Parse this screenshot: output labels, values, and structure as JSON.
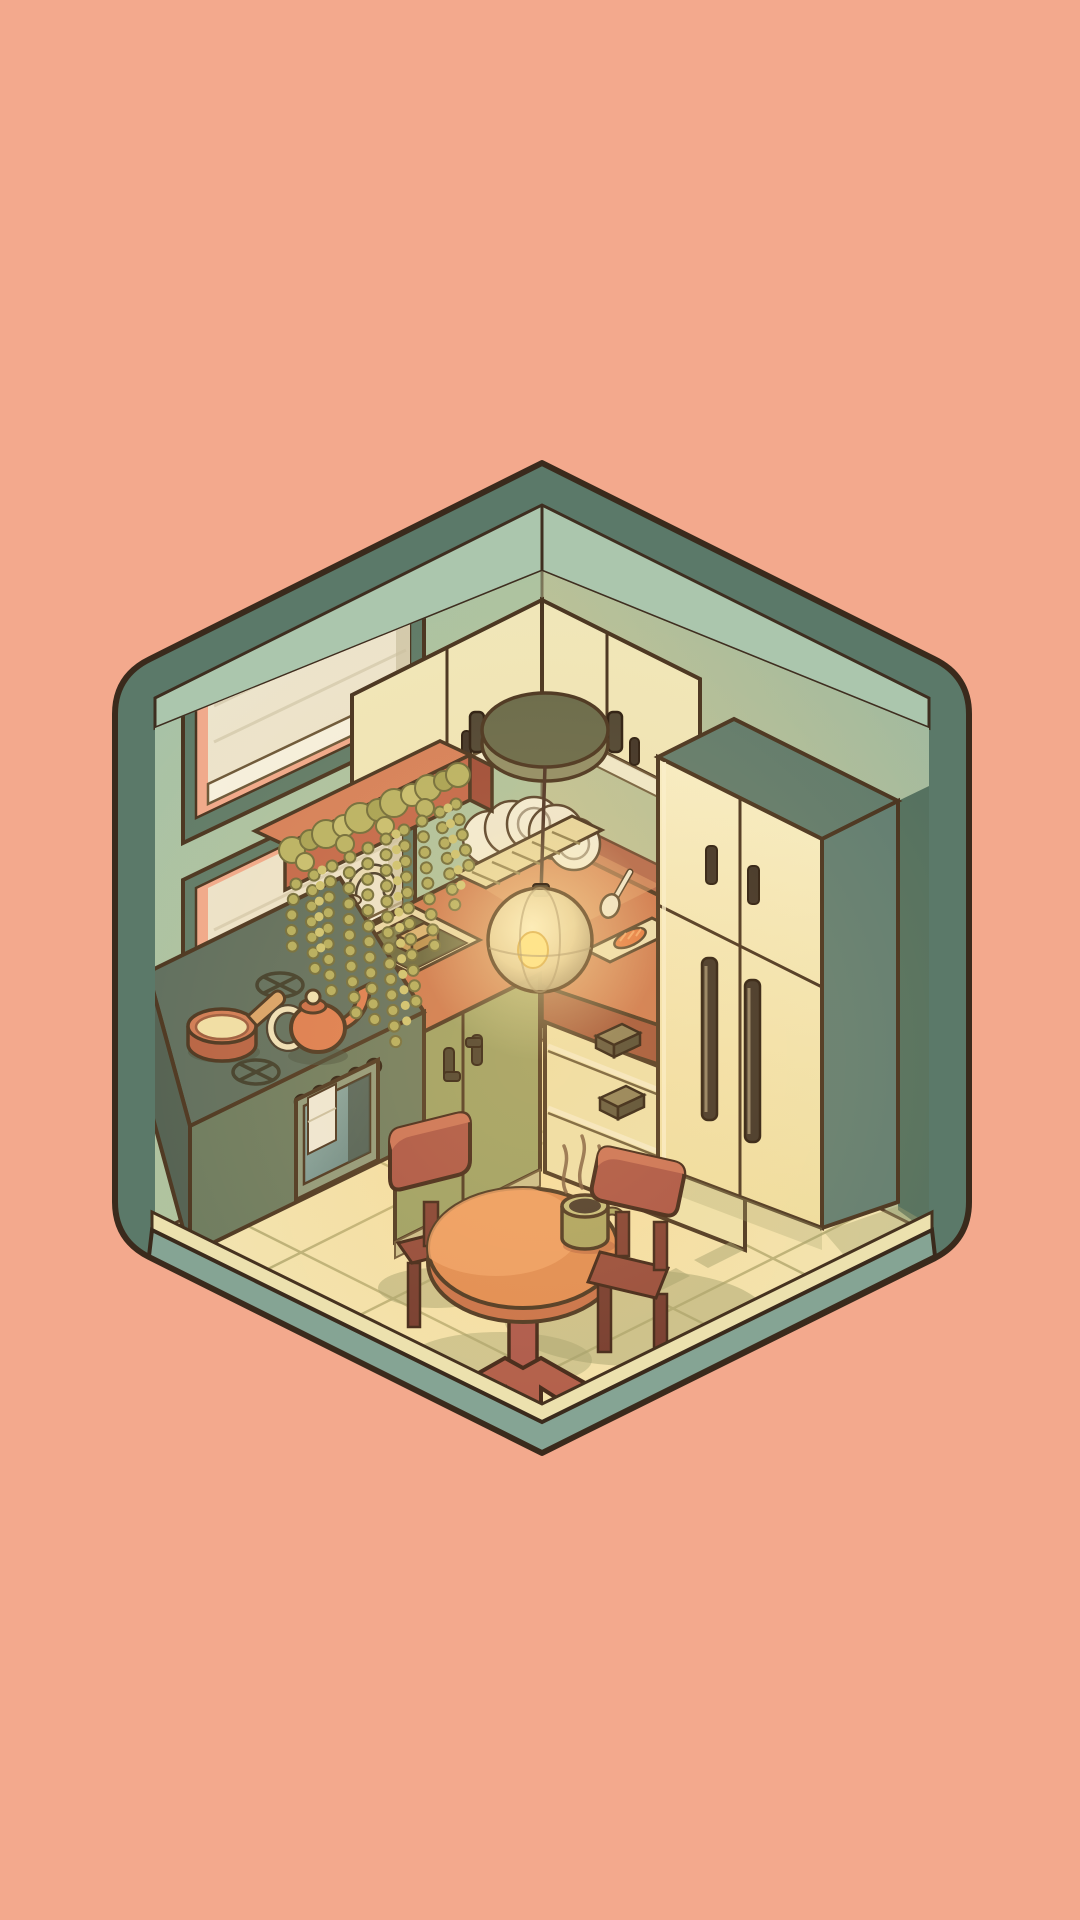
{
  "meta": {
    "scene": "Isometric cozy kitchen diorama in a rounded hexagon cutaway",
    "style": "hand-drawn cartoon, warm evening lamp light",
    "text_on_screen": ""
  },
  "palette": {
    "background": "#f3a98d",
    "ink": "#46321f",
    "roof_teal": "#5b7969",
    "ceiling_sage": "#abc6ad",
    "wall_sage": "#a6c2a8",
    "wall_glow": "#c9c792",
    "floor_cream": "#f0e6b6",
    "floor_border": "#ece1ae",
    "plinth_teal": "#85a494",
    "counter_terracotta": "#cd7850",
    "counter_edge_red": "#a85a3e",
    "backsplash_brick": "#b2674c",
    "cabinet_cream": "#f0e7ba",
    "cabinet_olive": "#99a065",
    "stove_green": "#5a6c5e",
    "oven_glass_teal": "#7fa09e",
    "fridge_side_teal": "#5f7d72",
    "handle_dark": "#3b3026",
    "table_orange": "#e08b52",
    "chair_red": "#a85044",
    "plant_olive": "#b2ad5e",
    "planter_terracotta": "#c2664a",
    "lamp_warm": "#ffe98f",
    "mug_olive": "#a9a462",
    "plate_white": "#f3eed9",
    "shadow_olive": "#9fa06e",
    "steam_brown": "#7a5a40"
  },
  "objects": {
    "frame": "rounded hexagon room shell",
    "window_upper": "upper window with cream roller blind",
    "window_lower": "lower window with cream roller blind",
    "hanging_plant": "trailing string-of-beads plant in terracotta wall box",
    "upper_cabinets": "cream wall cabinets on both walls",
    "range_hood": "dark round hood disc at the corner",
    "pendant_lamp": "glowing translucent globe pendant lamp",
    "dish_rack": "rack with white plates",
    "sink": "inset sink with faucet and bread loaf",
    "cutting_board": "board with fish and spoon",
    "stove": "green stove with two burners and oven",
    "saucepan": "terracotta saucepan with batter",
    "teapot": "orange teapot",
    "fridge": "tall cream fridge with long handles",
    "dining_table": "round orange pedestal table",
    "mug": "steaming olive mug",
    "chairs": "two red-brown chairs",
    "floor": "cream tiled floor with warm glow and shadows"
  }
}
